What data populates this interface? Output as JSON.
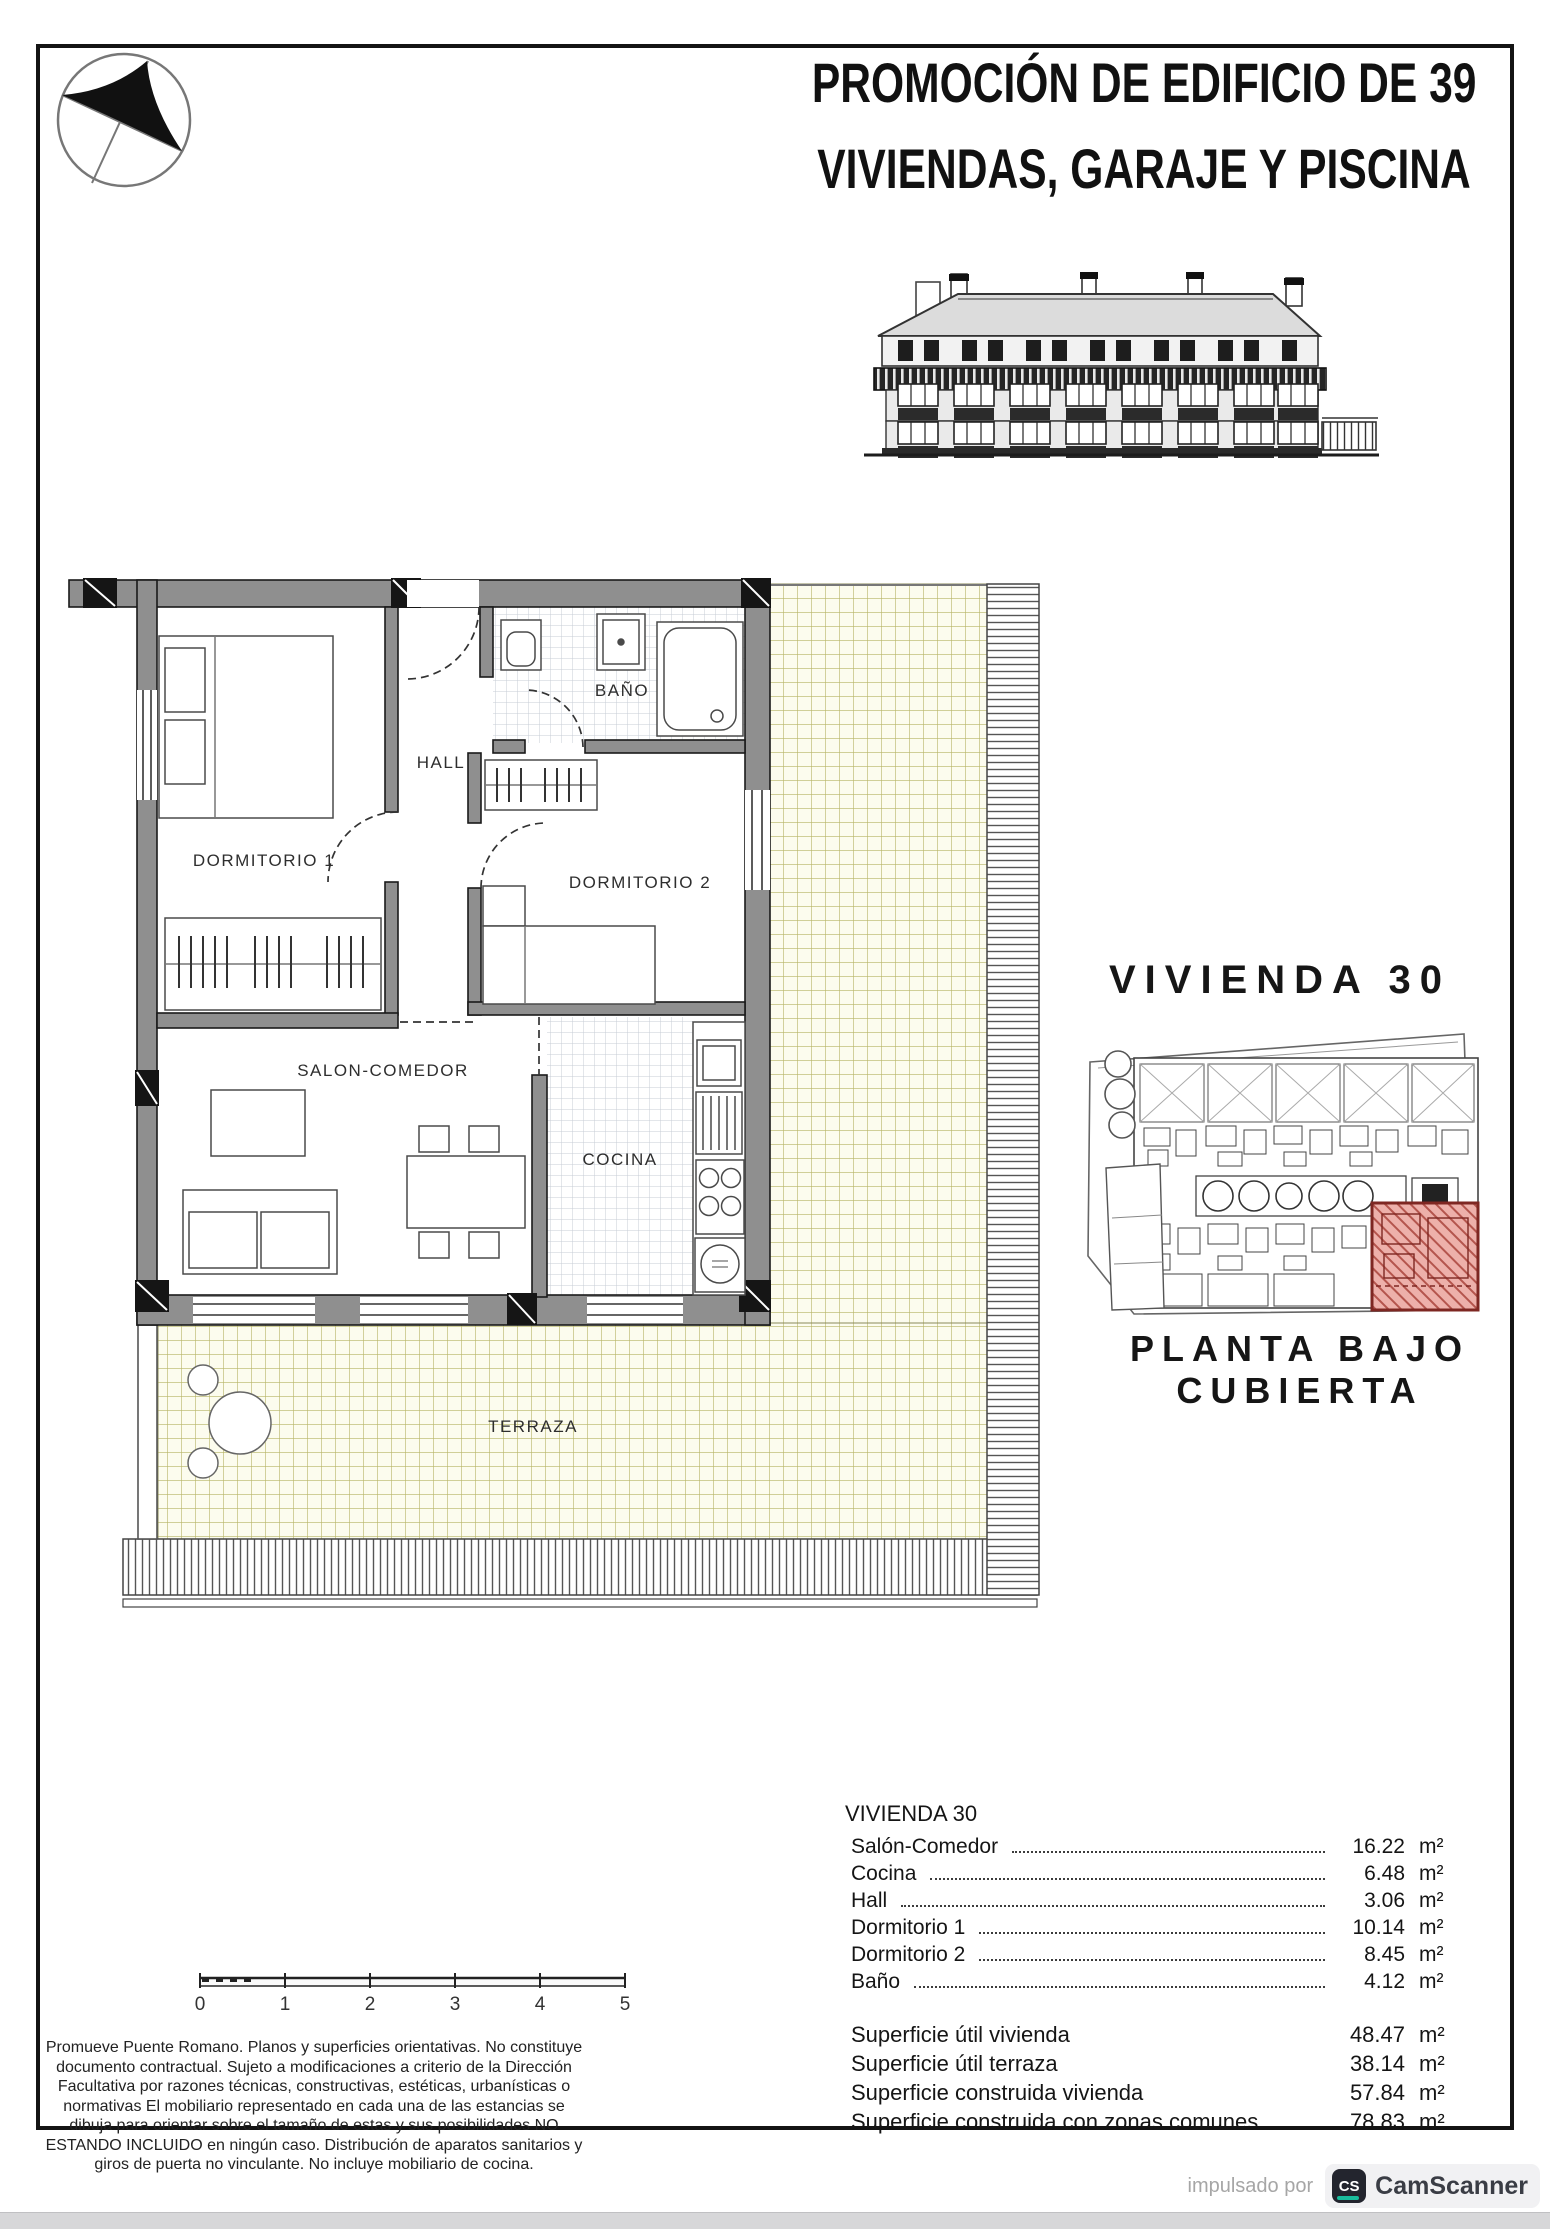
{
  "header": {
    "title_line1": "PROMOCIÓN DE EDIFICIO DE 39",
    "title_line2": "VIVIENDAS, GARAJE Y PISCINA"
  },
  "floor_plan": {
    "rooms": {
      "dormitorio1": "DORMITORIO 1",
      "hall": "HALL",
      "bano": "BAÑO",
      "dormitorio2": "DORMITORIO 2",
      "salon": "SALON-COMEDOR",
      "cocina": "COCINA",
      "terraza": "TERRAZA"
    }
  },
  "unit_panel": {
    "title": "VIVIENDA 30",
    "caption_line1": "PLANTA BAJO",
    "caption_line2": "CUBIERTA"
  },
  "area_table": {
    "header": "VIVIENDA 30",
    "unit": "m²",
    "rows": [
      {
        "label": "Salón-Comedor",
        "value": "16.22"
      },
      {
        "label": "Cocina",
        "value": "6.48"
      },
      {
        "label": "Hall",
        "value": "3.06"
      },
      {
        "label": "Dormitorio 1",
        "value": "10.14"
      },
      {
        "label": "Dormitorio 2",
        "value": "8.45"
      },
      {
        "label": "Baño",
        "value": "4.12"
      }
    ],
    "summary": [
      {
        "label": "Superficie útil vivienda",
        "value": "48.47"
      },
      {
        "label": "Superficie útil terraza",
        "value": "38.14"
      },
      {
        "label": "Superficie construida vivienda",
        "value": "57.84"
      },
      {
        "label": "Superficie construida con zonas comunes",
        "value": "78.83"
      }
    ]
  },
  "scale_bar": {
    "labels": [
      "0",
      "1",
      "2",
      "3",
      "4",
      "5"
    ]
  },
  "disclaimer": "Promueve Puente Romano. Planos y superficies orientativas. No constituye documento contractual. Sujeto a modificaciones a criterio de la Dirección Facultativa por razones técnicas, constructivas, estéticas, urbanísticas o normativas El mobiliario representado en cada una de las estancias se dibuja para orientar sobre el tamaño de estas y sus posibilidades NO ESTANDO INCLUIDO en ningún caso. Distribución de aparatos sanitarios y giros de puerta no vinculante. No incluye mobiliario de cocina.",
  "watermark": {
    "prefix": "impulsado por",
    "logo": "CS",
    "brand": "CamScanner"
  },
  "colors": {
    "wall_gray": "#8f8f8f",
    "terrace_grid_line": "#b7b465",
    "terrace_bg": "#fcfcee",
    "bath_tile_line": "#c7ccd6",
    "highlight_unit_fill": "#edb0aa",
    "highlight_unit_border": "#7e2722",
    "camscanner_teal": "#19bc9c"
  }
}
